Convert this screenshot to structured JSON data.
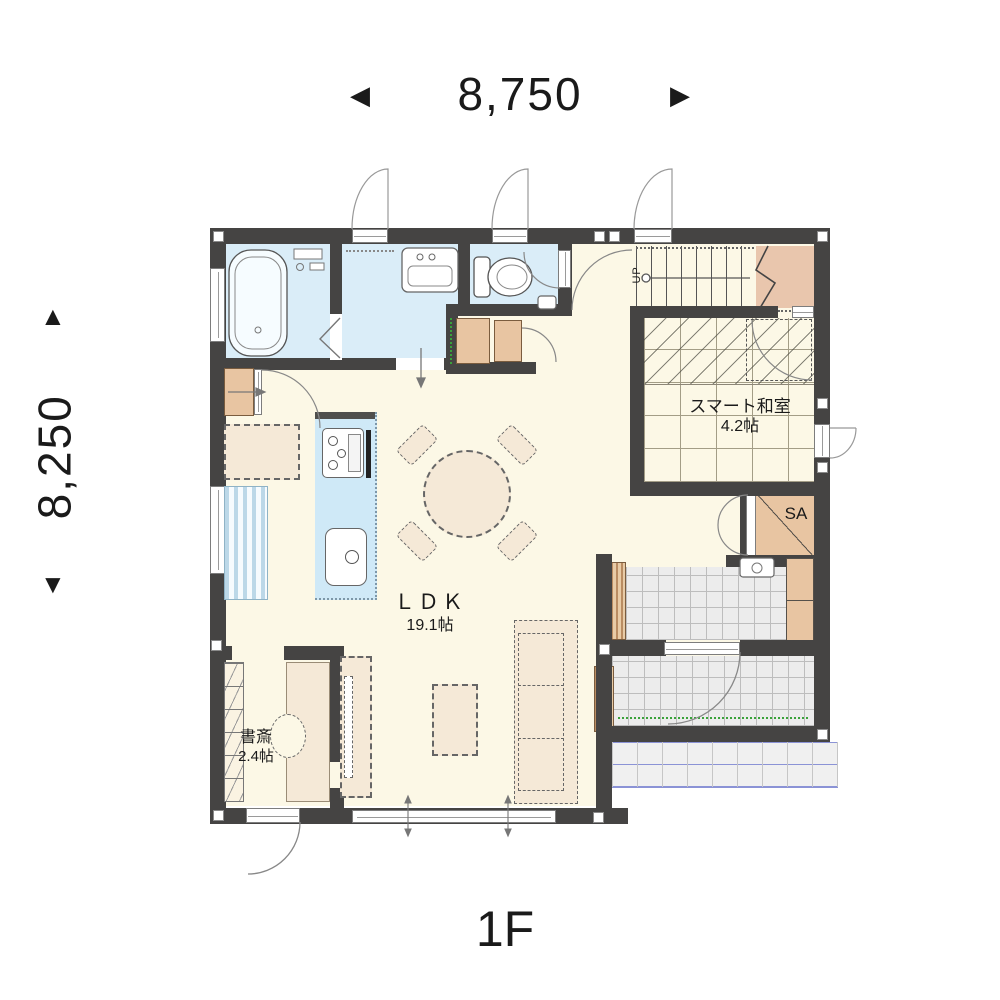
{
  "plan": {
    "floor_label": "1F",
    "dimensions": {
      "width": "8,750",
      "height": "8,250",
      "arrow_left": "◀",
      "arrow_right": "▶",
      "arrow_up": "▲",
      "arrow_down": "▼"
    },
    "rooms": {
      "ldk": {
        "name": "ＬＤＫ",
        "area": "19.1帖"
      },
      "smart_washitsu": {
        "name": "スマート和室",
        "area": "4.2帖"
      },
      "study": {
        "name": "書斎",
        "area": "2.4帖"
      },
      "shoe_closet": {
        "name": "SA"
      },
      "stairs": {
        "direction_label": "UP"
      }
    },
    "colors": {
      "wall": "#454443",
      "floor_cream": "#fcf8e6",
      "wet_room_blue": "#daedf8",
      "kitchen_counter_blue": "#cfe9f7",
      "closet_tan": "#e8c5a2",
      "stair_landing_tan": "#e9c6ad",
      "furniture_beige": "#f5e9d7",
      "entrance_tile_gray": "#ececec",
      "porch_line_blue": "#8b93d6",
      "step_edge_green": "#3aa23a"
    }
  }
}
